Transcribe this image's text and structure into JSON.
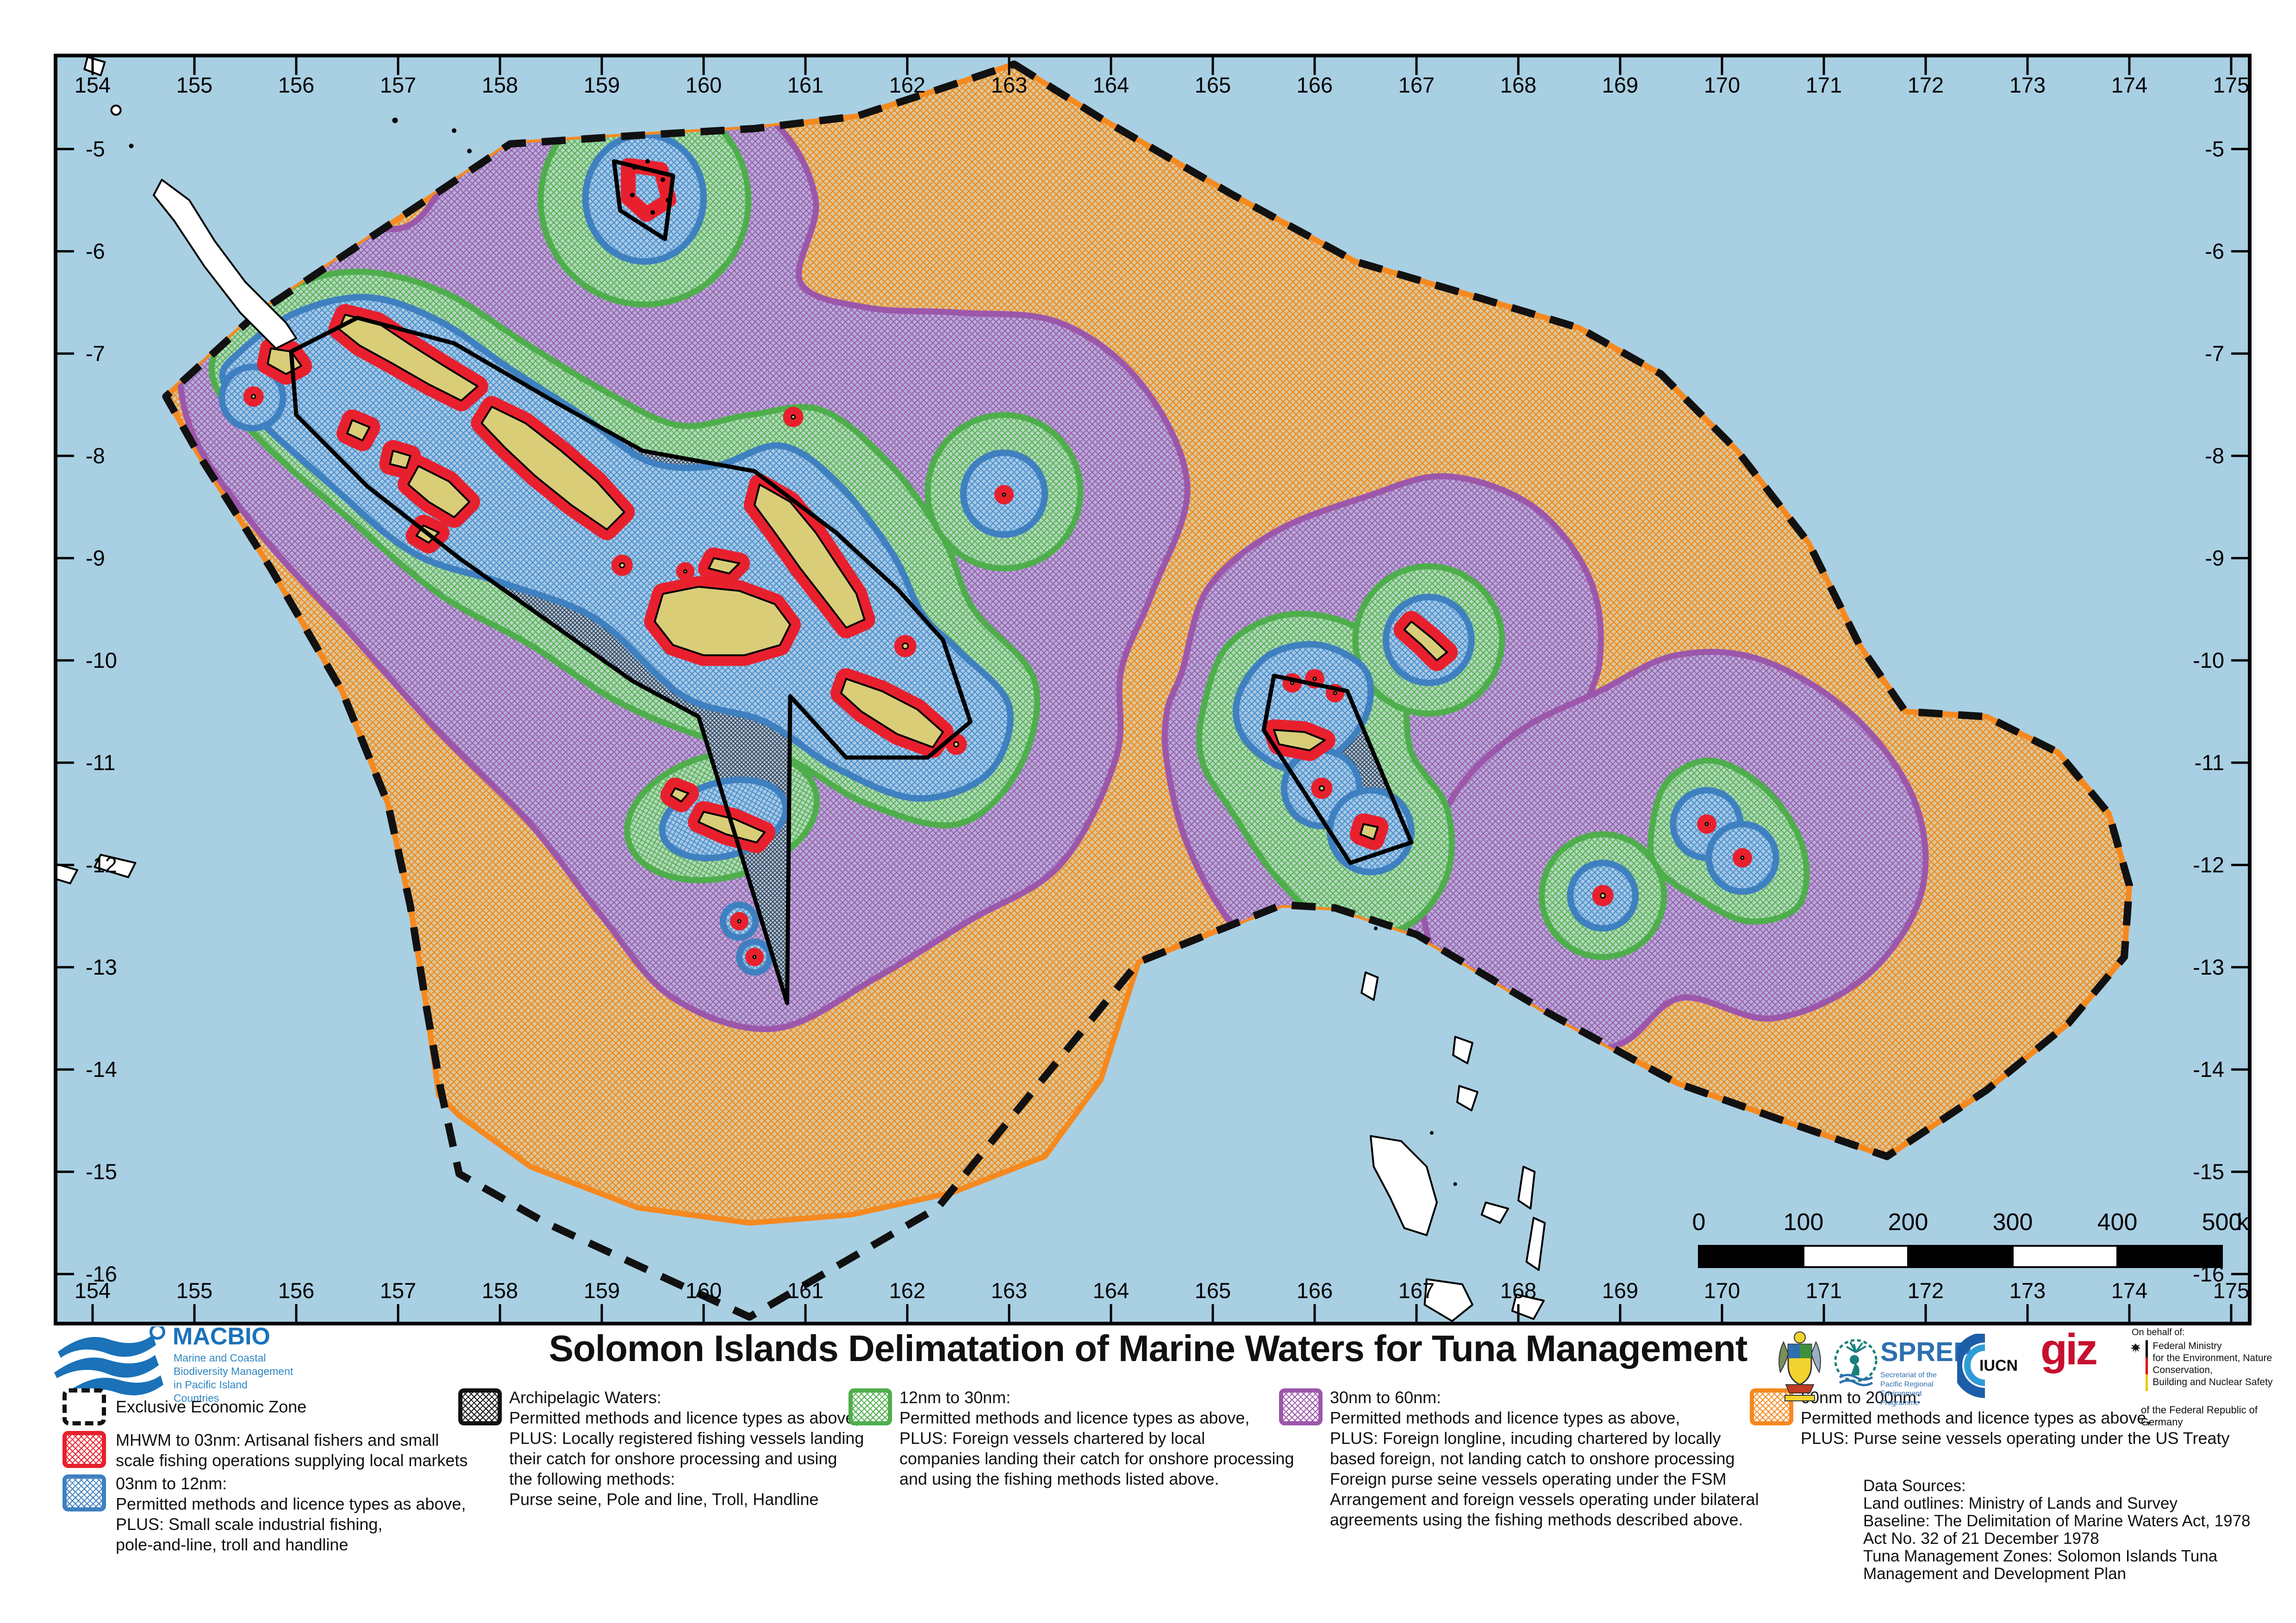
{
  "map": {
    "axes": {
      "lon_labels": [
        "154",
        "155",
        "156",
        "157",
        "158",
        "159",
        "160",
        "161",
        "162",
        "163",
        "164",
        "165",
        "166",
        "167",
        "168",
        "169",
        "170",
        "171",
        "172",
        "173",
        "174",
        "175"
      ],
      "lat_labels": [
        "-5",
        "-6",
        "-7",
        "-8",
        "-9",
        "-10",
        "-11",
        "-12",
        "-13",
        "-14",
        "-15",
        "-16"
      ]
    },
    "scale_bar": {
      "tick_labels": [
        "0",
        "100",
        "200",
        "300",
        "400",
        "500"
      ],
      "unit": "km"
    },
    "colors": {
      "ocean": "#a9cfe3",
      "eez_line": "#111111",
      "zone_60_200": "#f5891f",
      "zone_30_60": "#9c57ab",
      "zone_12_30": "#4fae4c",
      "zone_03_12": "#3f80c0",
      "zone_mhwm_03": "#e8202d",
      "archipelagic": "#111111",
      "island_fill": "#d9cd78",
      "foreign_land": "#ffffff"
    }
  },
  "footer": {
    "title": "Solomon Islands Delimatation of Marine Waters for Tuna Management",
    "macbio": {
      "name": "MACBIO",
      "tagline1": "Marine and Coastal",
      "tagline2": "Biodiversity Management",
      "tagline3": "in Pacific Island Countries"
    },
    "legend": {
      "eez": {
        "label": "Exclusive Economic Zone"
      },
      "mhwm": {
        "line1": "MHWM to 03nm: Artisanal fishers and small",
        "line2": "scale fishing operations supplying local markets"
      },
      "nm03": {
        "line1": "03nm to 12nm:",
        "line2": "Permitted methods and licence types as above,",
        "line3": "PLUS: Small scale industrial fishing,",
        "line4": "pole-and-line, troll and handline"
      },
      "archipelagic": {
        "line1": "Archipelagic Waters:",
        "line2": "Permitted methods and licence types as above,",
        "line3": "PLUS: Locally registered fishing vessels landing",
        "line4": "their catch for onshore processing and using",
        "line5": "the following methods:",
        "line6": "Purse seine, Pole and line, Troll, Handline"
      },
      "nm12_30": {
        "line1": "12nm to 30nm:",
        "line2": "Permitted methods and licence types as above,",
        "line3": "PLUS: Foreign vessels chartered by local",
        "line4": "companies landing their catch for onshore processing",
        "line5": "and using the fishing methods listed above."
      },
      "nm30_60": {
        "line1": "30nm to 60nm:",
        "line2": "Permitted methods and licence types as above,",
        "line3": "PLUS: Foreign longline, incuding chartered by locally",
        "line4": "based foreign, not landing catch to onshore processing",
        "line5": "Foreign purse seine vessels operating under the FSM",
        "line6": "Arrangement and foreign vessels operating under bilateral",
        "line7": "agreements using the fishing methods described above."
      },
      "nm60_200": {
        "line1": "60nm to 200nm:",
        "line2": "Permitted methods and licence types as above,",
        "line3": "PLUS: Purse seine vessels operating under the US Treaty"
      }
    },
    "data_sources": {
      "line1": "Data Sources:",
      "line2": "Land outlines: Ministry of Lands and Survey",
      "line3": "Baseline: The Delimitation of Marine Waters Act, 1978",
      "line4": "Act No. 32 of 21 December 1978",
      "line5": "Tuna Management Zones: Solomon Islands Tuna",
      "line6": "Management and Development Plan"
    },
    "logos": {
      "sprep": {
        "name": "SPREP",
        "sub1": "Secretariat of the Pacific Regional",
        "sub2": "Environment Programme"
      },
      "iucn": {
        "name": "IUCN"
      },
      "giz": {
        "name": "giz"
      },
      "ministry": {
        "on_behalf": "On behalf of:",
        "line1": "Federal Ministry",
        "line2": "for the Environment, Nature Conservation,",
        "line3": "Building and Nuclear Safety",
        "sub": "of the Federal Republic of Germany"
      }
    }
  }
}
